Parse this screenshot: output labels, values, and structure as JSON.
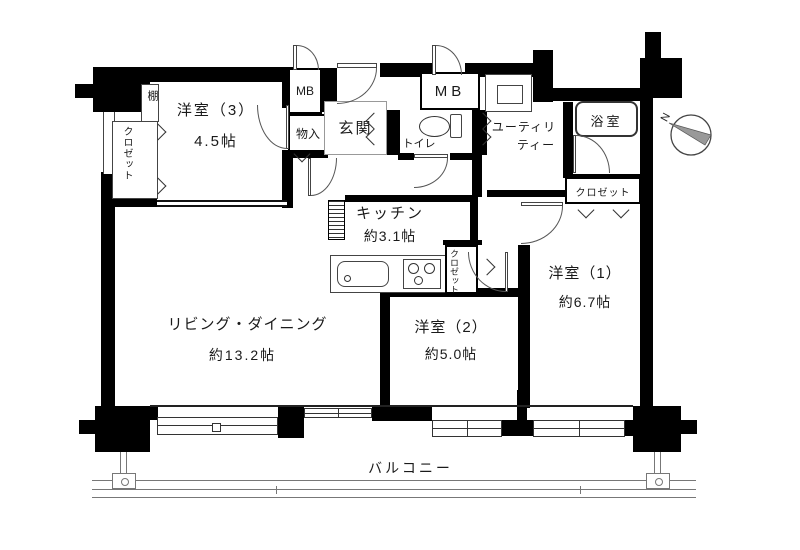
{
  "labels": {
    "room3": {
      "name": "洋室（3）",
      "size": "4.5帖"
    },
    "living": {
      "name": "リビング・ダイニング",
      "size": "約13.2帖"
    },
    "kitchen": {
      "name": "キッチン",
      "size": "約3.1帖"
    },
    "room2": {
      "name": "洋室（2）",
      "size": "約5.0帖"
    },
    "room1": {
      "name": "洋室（1）",
      "size": "約6.7帖"
    },
    "bath": "浴室",
    "toilet": "トイレ",
    "utility_line1": "ユーティリ",
    "utility_line2": "ティー",
    "entrance": "玄関",
    "storage": "物入",
    "shelf": "棚",
    "mb_left": "MB",
    "mb_right": "MB",
    "closet_room3": "クロゼット",
    "closet_room1": "クロゼット",
    "closet_room2": "クロゼット",
    "balcony": "バルコニー",
    "compass_north": "N"
  },
  "colors": {
    "wall": "#000000",
    "floor": "#ffffff",
    "line": "#555555",
    "needle": "#999999"
  }
}
